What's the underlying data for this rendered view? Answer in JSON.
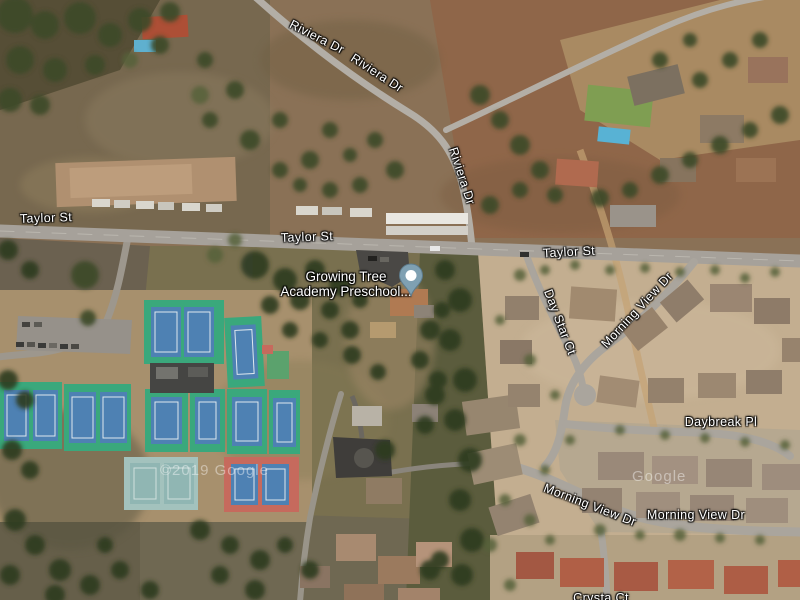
{
  "map": {
    "view_type": "satellite",
    "road_labels": [
      {
        "id": "riviera-dr-1",
        "text": "Riviera Dr"
      },
      {
        "id": "riviera-dr-2",
        "text": "Riviera Dr"
      },
      {
        "id": "riviera-dr-3",
        "text": "Riviera Dr"
      },
      {
        "id": "taylor-st-1",
        "text": "Taylor St"
      },
      {
        "id": "taylor-st-2",
        "text": "Taylor St"
      },
      {
        "id": "taylor-st-3",
        "text": "Taylor St"
      },
      {
        "id": "day-star-ct",
        "text": "Day Star Ct"
      },
      {
        "id": "morning-view-dr-1",
        "text": "Morning View Dr"
      },
      {
        "id": "daybreak-pl",
        "text": "Daybreak Pl"
      },
      {
        "id": "morning-view-dr-2",
        "text": "Morning View Dr"
      },
      {
        "id": "morning-view-dr-3",
        "text": "Morning View Dr"
      },
      {
        "id": "crysta-ct",
        "text": "Crysta Ct"
      }
    ],
    "poi": {
      "line1": "Growing Tree",
      "line2": "Academy Preschool...",
      "marker_color": "#7fa0b2"
    },
    "watermarks": [
      {
        "text": "©2019 Google"
      },
      {
        "text": "Google"
      }
    ],
    "colors": {
      "court_green": "#3aa87c",
      "court_blue": "#4e81b3",
      "court_red": "#c66a5d",
      "road_gray": "#a6a19a",
      "residential_ground": "#c3ae90"
    }
  }
}
